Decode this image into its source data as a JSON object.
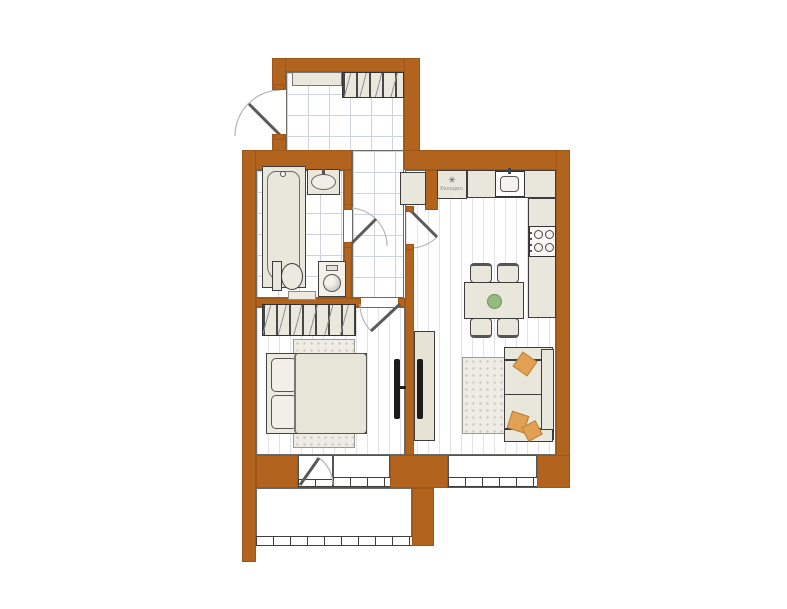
{
  "fridge": {
    "label": "Холодил.",
    "snowflake_icon": "✳"
  },
  "colors": {
    "wall_brown": "#b2641f",
    "wall_brown_edge": "#9c5617",
    "furniture_fill": "#e9e6db",
    "outline_dark": "#3d3d3d",
    "tile_line": "#cdd3df",
    "plank_line": "#e2e3ea",
    "rug_fill": "#eeece4",
    "rug_dot": "#c8c6ba",
    "pillow_orange": "#e2a055",
    "plant_green": "#93bb7d",
    "tv_black": "#1b1b1b",
    "door_arc_gray": "#b5b5b5"
  }
}
